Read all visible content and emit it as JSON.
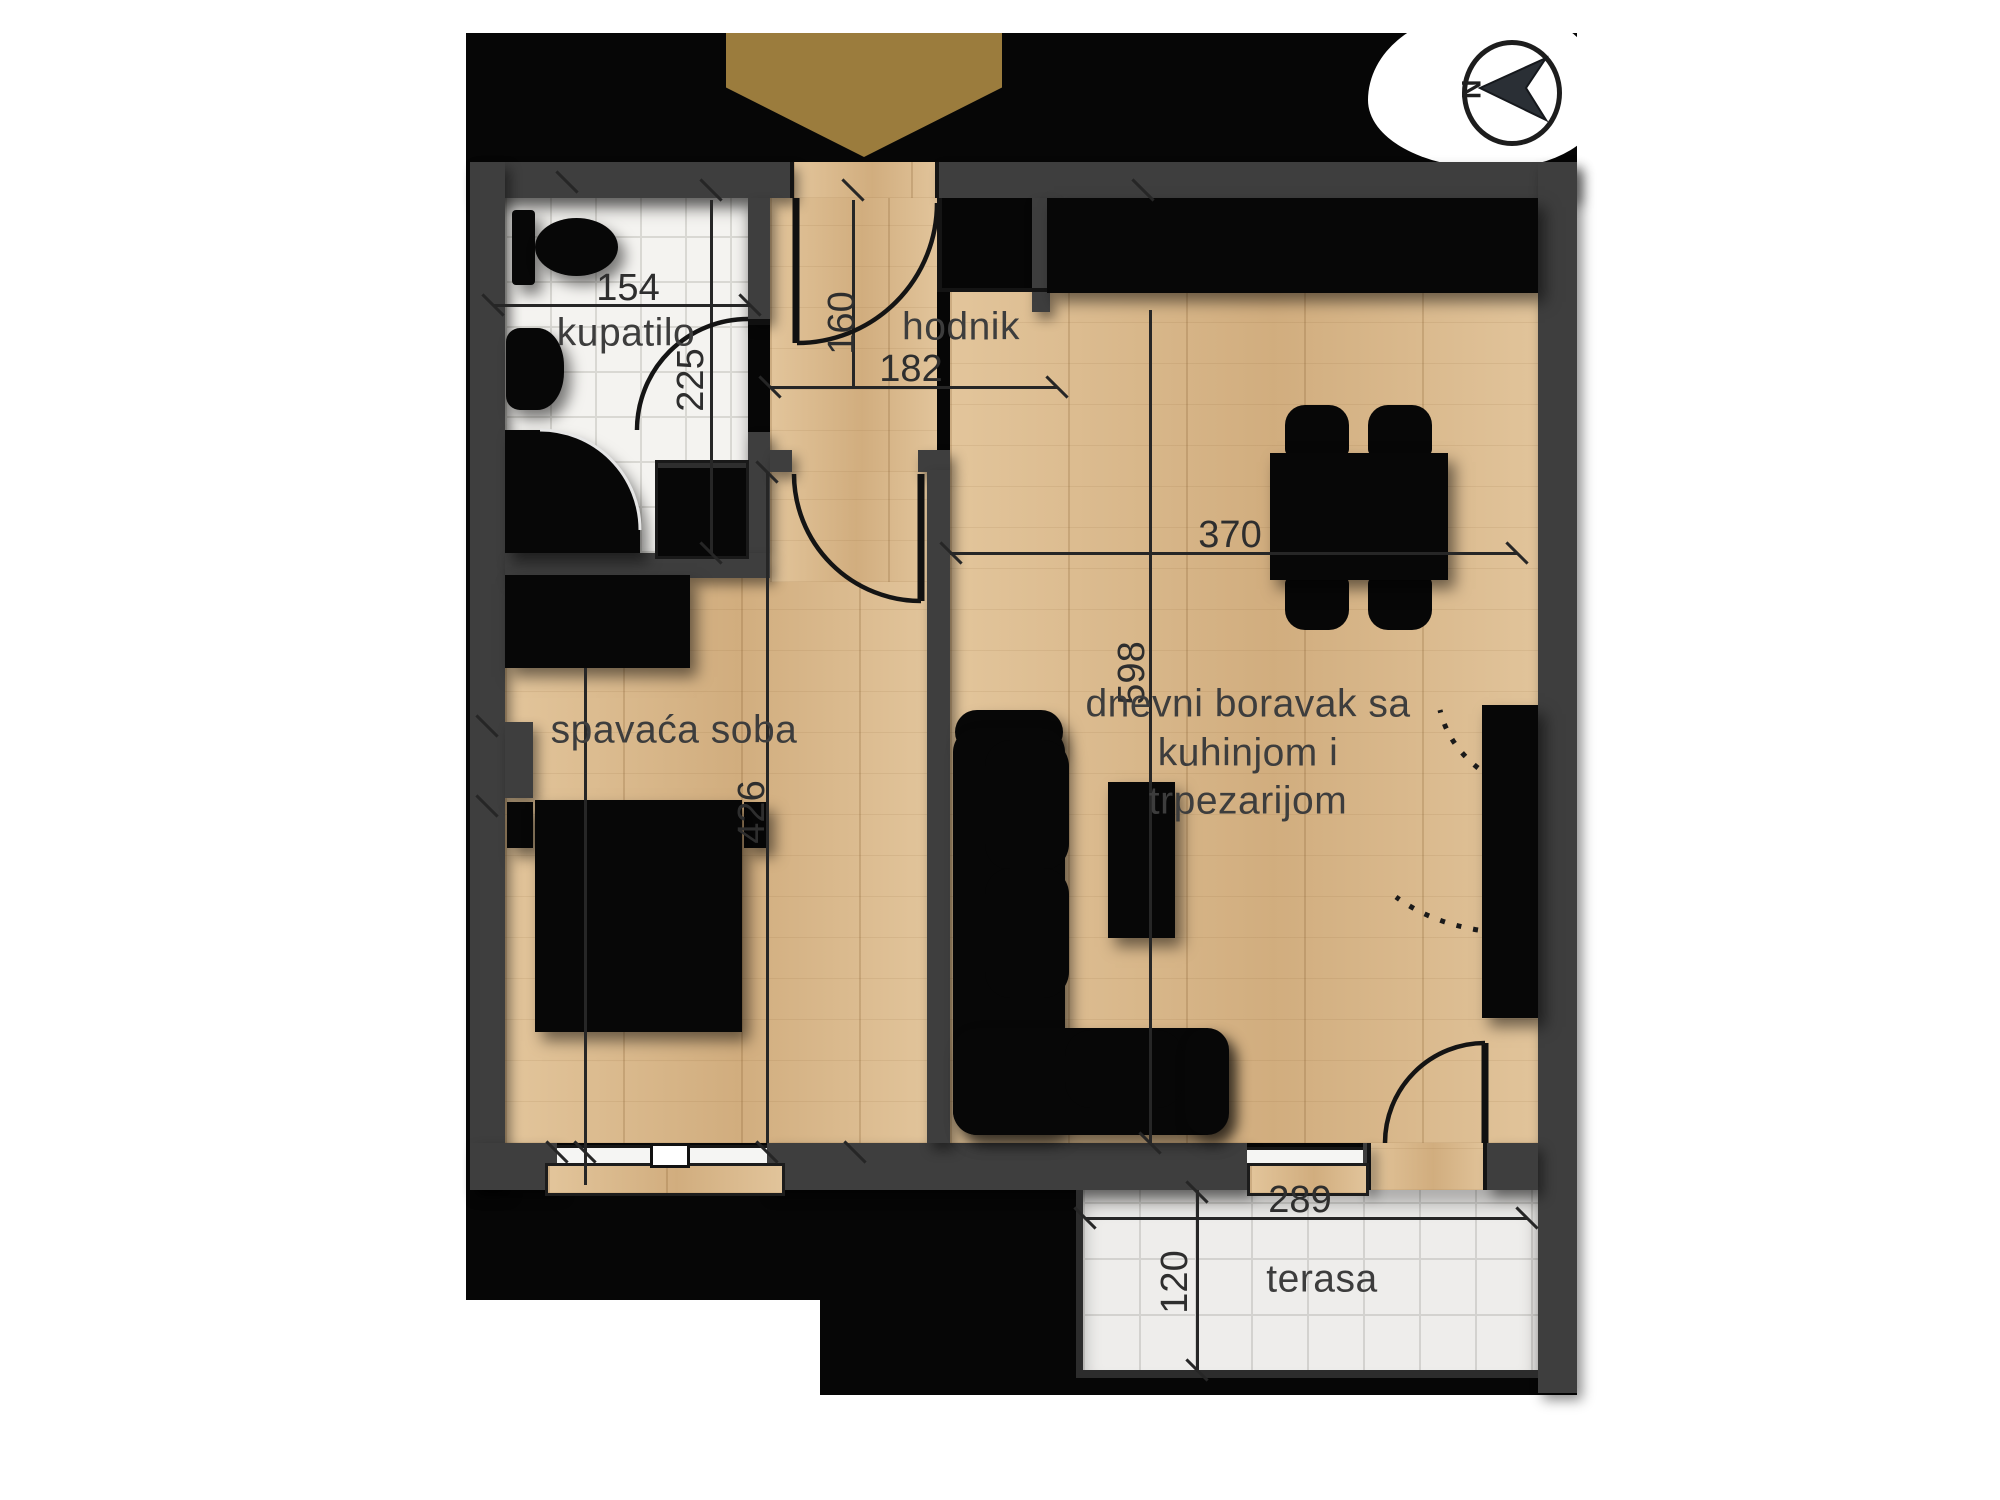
{
  "plan": {
    "compass": {
      "north_label": "N"
    },
    "rooms": {
      "bathroom": {
        "label": "kupatilo"
      },
      "hallway": {
        "label": "hodnik"
      },
      "bedroom": {
        "label": "spavaća soba"
      },
      "living": {
        "label_line1": "dnevni boravak sa",
        "label_line2": "kuhinjom i",
        "label_line3": "trpezarijom"
      },
      "terrace": {
        "label": "terasa"
      }
    },
    "dimensions_cm": {
      "bathroom_width": "154",
      "bathroom_depth": "225",
      "hallway_depth": "160",
      "hallway_width": "182",
      "living_width": "370",
      "living_depth": "598",
      "bedroom_depth": "426",
      "terrace_width": "289",
      "terrace_depth": "120"
    },
    "colors": {
      "wall": "#3e3e3e",
      "wood_floor": "#d9b88c",
      "tile_floor": "#f4f3f0",
      "entrance_marker": "#9b7c3d",
      "background": "#ffffff",
      "plan_backdrop": "#060606"
    }
  }
}
